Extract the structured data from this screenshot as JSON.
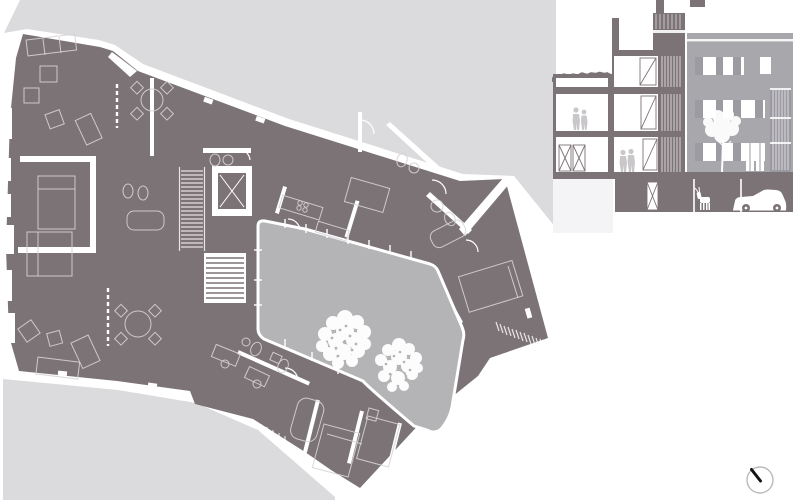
{
  "canvas": {
    "width": 800,
    "height": 500,
    "background": "#ffffff"
  },
  "colors": {
    "street": "#dbdadc",
    "building": "#7c7377",
    "courtyard": "#b4b3b6",
    "facade": "#a8a7ac",
    "facade_shutter": "#9c9ba2",
    "facade_bay": "#9b9aa1",
    "drawing_line": "#ffffff",
    "furniture_line": "#d6d3d6",
    "figure": "#c9c7ca",
    "underlay": "#f4f3f5",
    "compass_ring": "#b9b9b9",
    "compass_needle": "#141414"
  },
  "plan": {
    "name": "ground-floor-plan",
    "courtyard_trees": 2
  },
  "section": {
    "name": "cross-section-and-street-elevation",
    "people": 4,
    "cars": 1,
    "animals": 1,
    "facade_trees": 1
  },
  "compass": {
    "name": "north-arrow"
  }
}
